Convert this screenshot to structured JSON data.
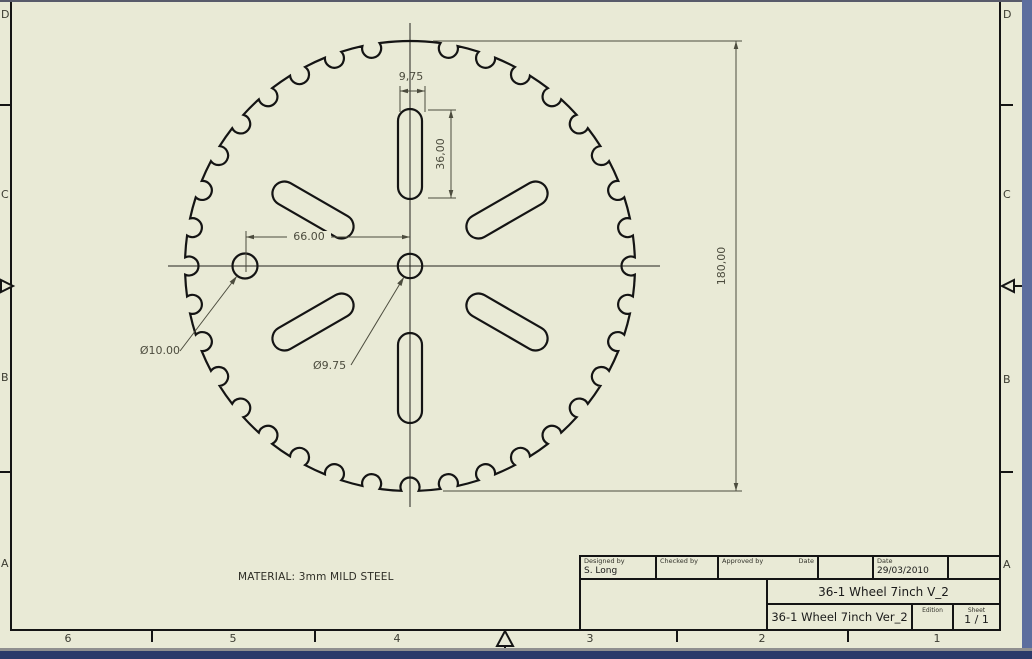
{
  "sheet": {
    "paper_color": "#e9ead6",
    "line_color": "#141414",
    "dim_color": "#4c4c3e"
  },
  "zones": {
    "left_letters": [
      "D",
      "C",
      "B",
      "A"
    ],
    "right_letters": [
      "D",
      "C",
      "B",
      "A"
    ],
    "bottom_numbers": [
      "6",
      "5",
      "4",
      "3",
      "2",
      "1"
    ]
  },
  "drawing": {
    "teeth": 36,
    "missing_teeth": 1,
    "outer_diameter_mm": 180,
    "scale_px_per_mm": 2.5,
    "center_px": [
      410,
      266
    ],
    "notch_radius_px": 9.5,
    "notch_center_offset_px": 4,
    "slot": {
      "count": 6,
      "length_px": 90,
      "width_px": 24,
      "center_radius_px": 112,
      "angles_deg": [
        -90,
        -30,
        30,
        90,
        150,
        210
      ]
    },
    "center_hole_radius_px": 12.2,
    "offset_hole_radius_px": 12.5,
    "offset_hole_center_px": [
      245,
      266
    ]
  },
  "dimensions": {
    "slot_width": "9,75",
    "slot_length": "36,00",
    "hole_offset": "66.00",
    "outer_diameter": "180,00",
    "offset_hole_dia": "Ø10.00",
    "center_hole_dia": "Ø9.75"
  },
  "notes": {
    "material": "MATERIAL: 3mm MILD STEEL"
  },
  "title_block": {
    "designed_by_label": "Designed by",
    "designed_by": "S. Long",
    "checked_by_label": "Checked by",
    "approved_by_label": "Approved by",
    "date_label_1": "Date",
    "date_label_2": "Date",
    "date_value": "29/03/2010",
    "title": "36-1 Wheel 7inch V_2",
    "subtitle": "36-1 Wheel 7inch Ver_2",
    "edition_label": "Edition",
    "sheet_label": "Sheet",
    "sheet_value": "1 / 1"
  }
}
